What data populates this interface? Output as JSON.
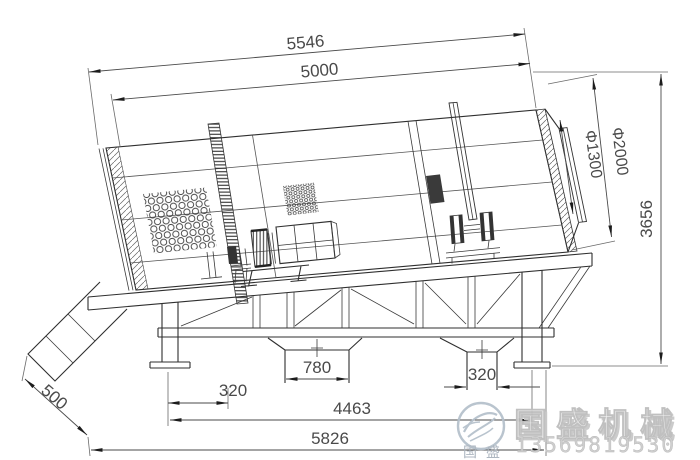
{
  "dimensions": {
    "top_overall": "5546",
    "drum_length": "5000",
    "outlet_diameter": "Φ1300",
    "drum_diameter": "Φ2000",
    "overall_height": "3656",
    "chute_extension": "500",
    "left_base_offset": "320",
    "left_hopper_width": "780",
    "right_hopper_width": "320",
    "leg_span": "4463",
    "base_length": "5826"
  },
  "watermark": {
    "company": "国盛机械",
    "company_compact": "国盛",
    "phone": "13569819530",
    "logo_icon": "bird-swoosh-logo",
    "logo_color": "#b6c1cc",
    "emboss_color": "#cfcfcf"
  },
  "drawing": {
    "line_color": "#2f2f2f",
    "dimension_color": "#4a4a4a",
    "background": "#ffffff"
  }
}
